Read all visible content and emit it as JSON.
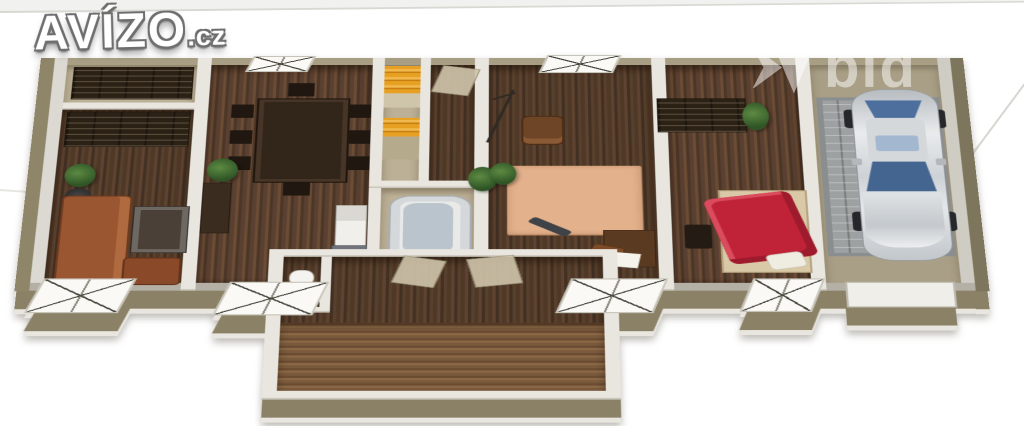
{
  "branding": {
    "logo_text": "AVÍZO",
    "logo_suffix": ".cz"
  },
  "watermark": {
    "text": "bid"
  },
  "scene": {
    "type": "3d-floorplan-render",
    "description": "Isometric 3D floor plan of a long single-storey house with attached garage and rear entrance hall",
    "rooms": [
      "storage-room",
      "living-room",
      "dining-room",
      "closets",
      "corridor",
      "bathroom",
      "study-room",
      "bedroom",
      "garage",
      "entrance-hall",
      "wc"
    ],
    "objects": [
      "shelving-units",
      "sofa",
      "floor-lamp",
      "plants",
      "dining-table-with-chairs",
      "washing-machine",
      "kitchen-counter",
      "bathtub",
      "yellow-closet-shelves",
      "area-rug",
      "armchair",
      "desk-with-chair",
      "wardrobe",
      "double-bed-red-duvet",
      "toilet",
      "silver-car",
      "paved-garage-floor",
      "french-windows"
    ],
    "palette": {
      "exterior_wall": "#8b8166",
      "outer_wall_top": "#a89e84",
      "inner_wall": "#e9e6e0",
      "floor_wood_dark": "#503827",
      "interior_beige": "#bcb096",
      "rug": "#e3b18c",
      "duvet_red": "#c02337",
      "sofa_brown": "#9a5531",
      "closet_yellow": "#e8a023",
      "car_silver": "#d5d9dc",
      "car_glass_blue": "#4d6f9e",
      "background": "#ffffff"
    }
  }
}
